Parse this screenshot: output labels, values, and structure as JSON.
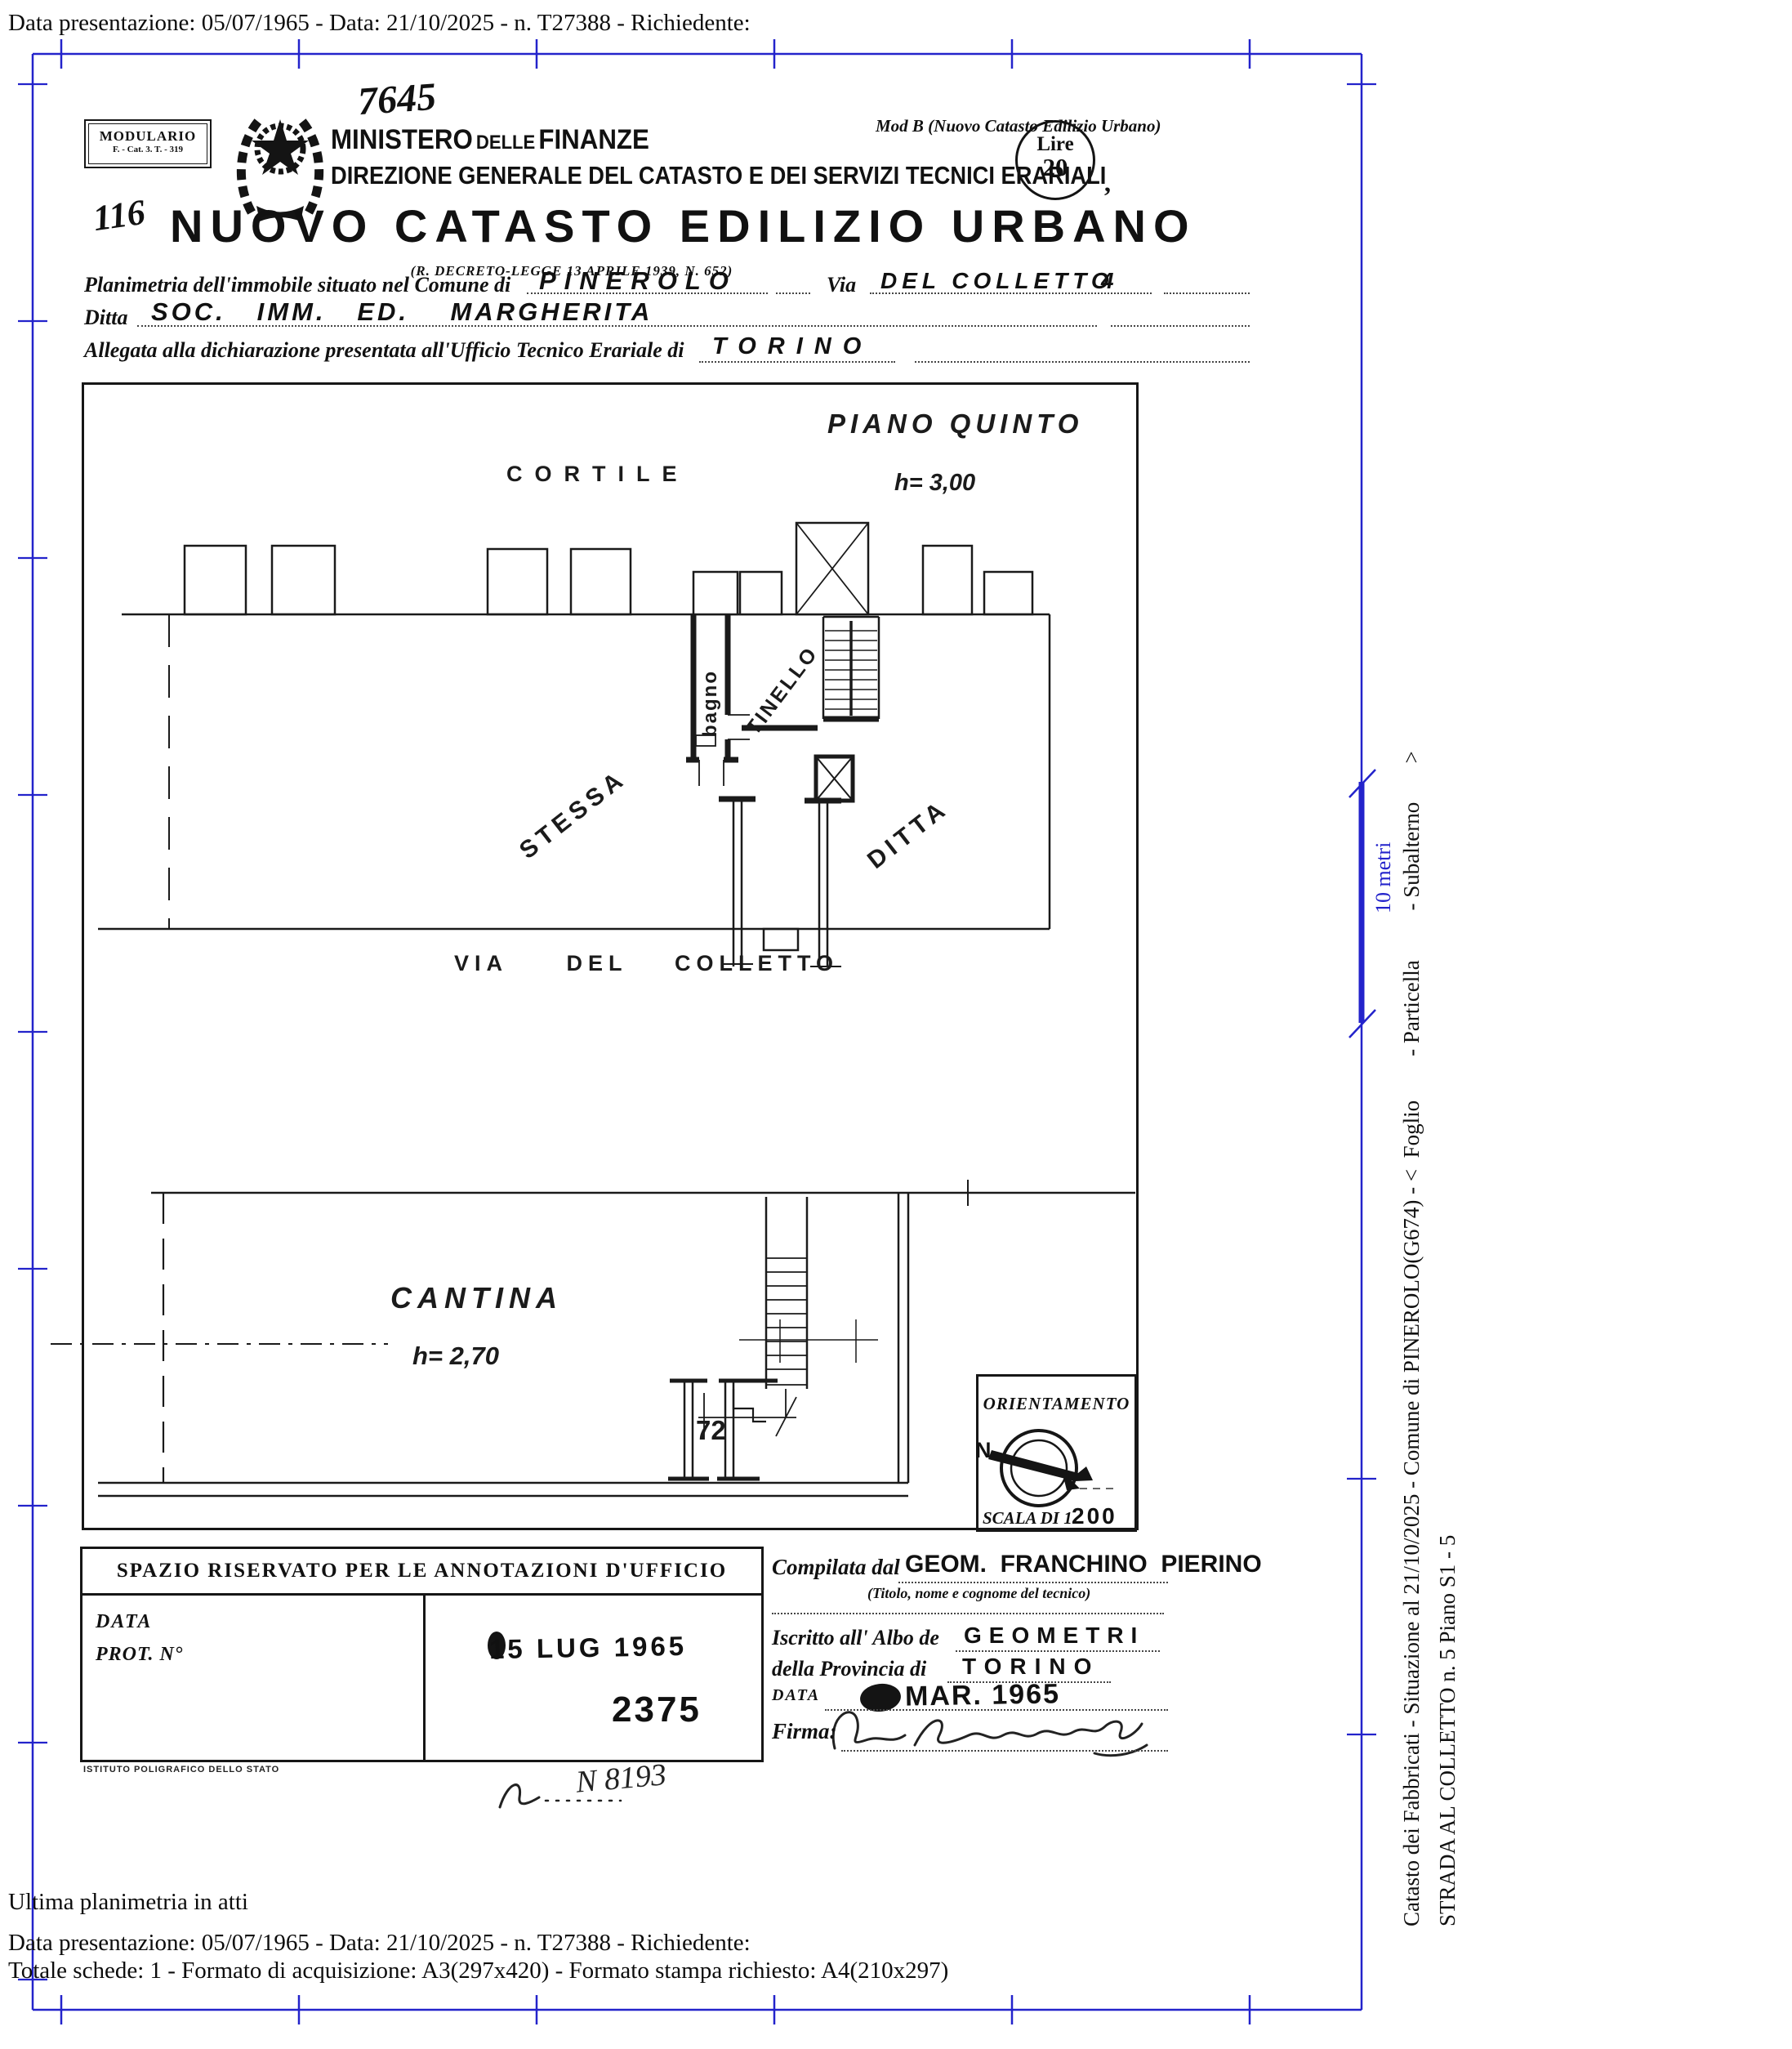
{
  "meta": {
    "top_line": "Data presentazione: 05/07/1965 - Data: 21/10/2025 - n. T27388 - Richiedente:"
  },
  "header": {
    "modulario_title": "MODULARIO",
    "modulario_code": "F. - Cat. 3. T. - 319",
    "handwritten_number": "7645",
    "handwritten_paraph": "116",
    "ministry_word1": "MINISTERO",
    "ministry_word2": "DELLE",
    "ministry_word3": "FINANZE",
    "direzione": "DIREZIONE GENERALE DEL CATASTO E DEI SERVIZI TECNICI ERARIALI",
    "mod_b": "Mod B (Nuovo Catasto Edilizio Urbano)",
    "stamp_lire": "Lire",
    "stamp_value": "20",
    "after_stamp": ",",
    "title": "NUOVO CATASTO EDILIZIO URBANO",
    "law": "(R. DECRETO-LEGGE 13 APRILE 1939, N. 652)"
  },
  "form": {
    "row1_label": "Planimetria dell'immobile situato nel Comune di",
    "row1_value": "PINEROLO",
    "row1_via_label": "Via",
    "row1_via_value": "DEL COLLETTO",
    "row1_civic": "4",
    "row2_label": "Ditta",
    "row2_value": "SOC.   IMM.   ED.    MARGHERITA",
    "row3_label": "Allegata alla dichiarazione presentata all'Ufficio Tecnico Erariale di",
    "row3_value": "TORINO"
  },
  "plan": {
    "courtyard": "CORTILE",
    "floor_title": "PIANO QUINTO",
    "floor_height": "h= 3,00",
    "room_bath": "bagno",
    "room_dining": "TINELLO",
    "label_stessa": "STESSA",
    "label_ditta": "DITTA",
    "street": "VIA     DEL    COLLETTO",
    "basement_title": "CANTINA",
    "basement_height": "h= 2,70",
    "cellar_number": "72"
  },
  "orientation": {
    "title": "ORIENTAMENTO",
    "north": "N",
    "scale_prefix": "SCALA DI 1.",
    "scale_value": "200"
  },
  "annotations": {
    "header": "SPAZIO RISERVATO PER LE ANNOTAZIONI D'UFFICIO",
    "label_data": "DATA",
    "label_prot": "PROT. N°",
    "stamp_date": "15 LUG 1965",
    "stamp_number": "2375",
    "printer": "ISTITUTO POLIGRAFICO DELLO STATO",
    "handwritten_ref": "N 8193"
  },
  "compiler": {
    "label": "Compilata dal",
    "name": "GEOM.  FRANCHINO  PIERINO",
    "caption": "(Titolo, nome e cognome del tecnico)",
    "albo_label": "Iscritto all' Albo de",
    "albo_value": "GEOMETRI",
    "prov_label": "della Provincia di",
    "prov_value": "TORINO",
    "date_label": "DATA",
    "date_stamp": "MAR. 1965",
    "firma_label": "Firma:"
  },
  "sidebar": {
    "line1": "Catasto dei Fabbricati - Situazione al 21/10/2025 - Comune di PINEROLO(G674) - <  Foglio        - Particella         - Subalterno       >",
    "line2": "STRADA AL COLLETTO n. 5 Piano S1 - 5",
    "scale_label": "10 metri"
  },
  "footer": {
    "line1": "Ultima planimetria in atti",
    "line2": "Data presentazione: 05/07/1965 - Data: 21/10/2025 - n. T27388 - Richiedente:",
    "line3": "Totale schede: 1 - Formato di acquisizione: A3(297x420)  - Formato stampa richiesto: A4(210x297)"
  },
  "colors": {
    "frame_blue": "#2323cb",
    "ink": "#141414"
  }
}
